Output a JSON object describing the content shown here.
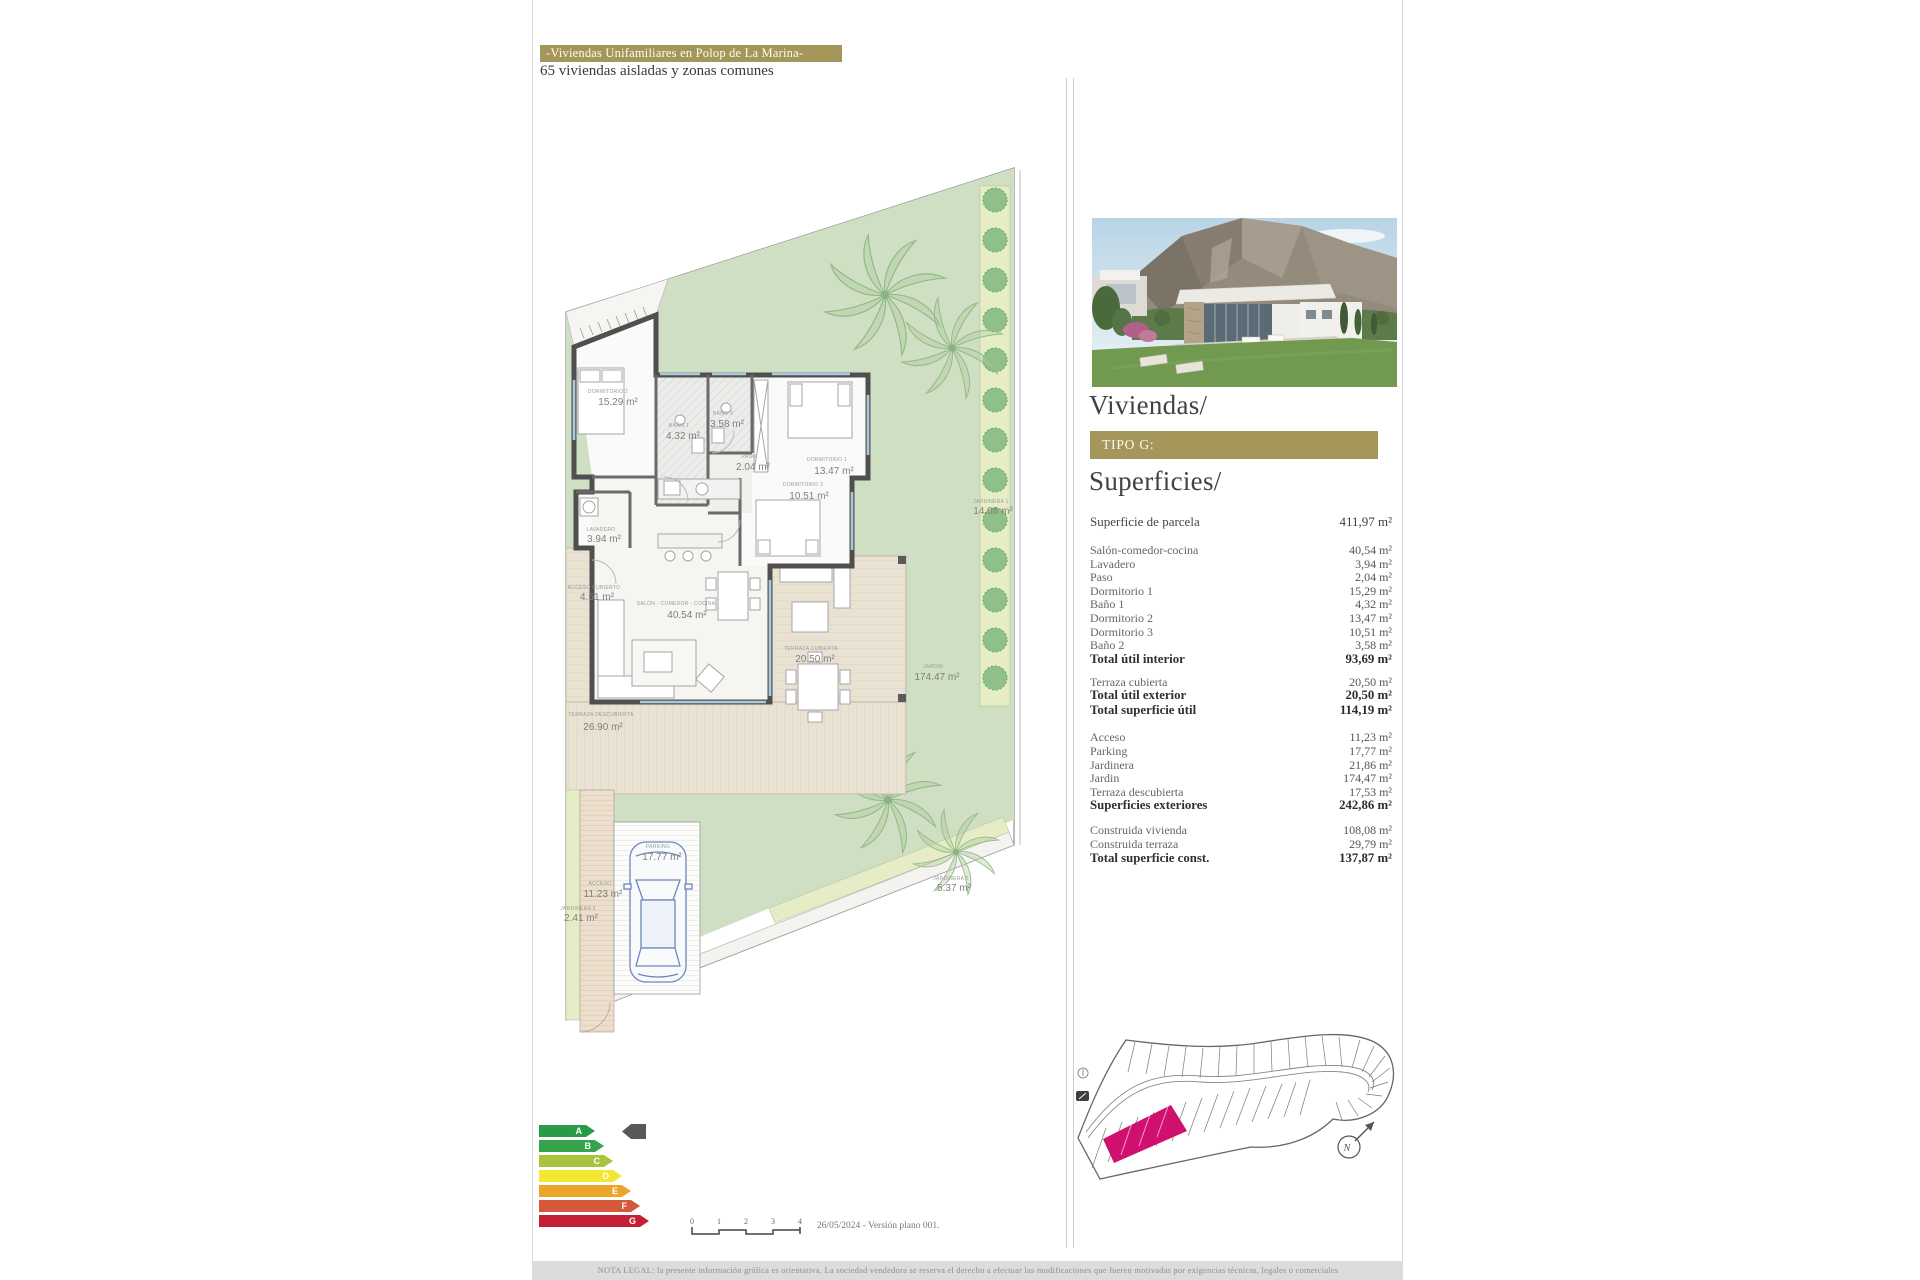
{
  "page": {
    "title": "-Viviendas Unifamiliares en Polop de La Marina-",
    "subtitle": "65 viviendas aisladas y zonas comunes",
    "legal": "NOTA LEGAL: la presente información gráfica es orientativa. La sociedad vendedora se reserva el derecho a efectuar las modificaciones que fueren motivadas por exigencias técnicas, legales o comerciales",
    "date_version": "26/05/2024 - Versión plano 001.",
    "accent_color": "#a59659"
  },
  "panel": {
    "viviendas_title": "Viviendas/",
    "tipo_label": "TIPO G:",
    "superficies_title": "Superficies/",
    "parcel": {
      "label": "Superficie de parcela",
      "value": "411,97 m²"
    },
    "interior": {
      "rows": [
        {
          "label": "Salón-comedor-cocina",
          "value": "40,54 m²"
        },
        {
          "label": "Lavadero",
          "value": "3,94 m²"
        },
        {
          "label": "Paso",
          "value": "2,04 m²"
        },
        {
          "label": "Dormitorio 1",
          "value": "15,29 m²"
        },
        {
          "label": "Baño 1",
          "value": "4,32 m²"
        },
        {
          "label": "Dormitorio 2",
          "value": "13,47 m²"
        },
        {
          "label": "Dormitorio 3",
          "value": "10,51 m²"
        },
        {
          "label": "Baño 2",
          "value": "3,58 m²"
        }
      ],
      "total": {
        "label": "Total útil interior",
        "value": "93,69 m²"
      }
    },
    "exterior_util": {
      "rows": [
        {
          "label": "Terraza cubierta",
          "value": "20,50 m²"
        }
      ],
      "total": {
        "label": "Total útil exterior",
        "value": "20,50 m²"
      },
      "total2": {
        "label": "Total superficie útil",
        "value": "114,19 m²"
      }
    },
    "exteriores": {
      "rows": [
        {
          "label": "Acceso",
          "value": "11,23 m²"
        },
        {
          "label": "Parking",
          "value": "17,77 m²"
        },
        {
          "label": "Jardinera",
          "value": "21,86 m²"
        },
        {
          "label": "Jardin",
          "value": "174,47 m²"
        },
        {
          "label": "Terraza descubierta",
          "value": "17,53 m²"
        }
      ],
      "total": {
        "label": "Superficies exteriores",
        "value": "242,86 m²"
      }
    },
    "construida": {
      "rows": [
        {
          "label": "Construida vivienda",
          "value": "108,08 m²"
        },
        {
          "label": "Construida terraza",
          "value": "29,79 m²"
        }
      ],
      "total": {
        "label": "Total superficie const.",
        "value": "137,87 m²"
      }
    }
  },
  "plan": {
    "labels": [
      {
        "name": "DORMITORIO 2",
        "area": "15.29 m²"
      },
      {
        "name": "BAÑO 1",
        "area": "4.32 m²"
      },
      {
        "name": "BAÑO 2",
        "area": "3.58 m²"
      },
      {
        "name": "PASO",
        "area": "2.04 m²"
      },
      {
        "name": "DORMITORIO 1",
        "area": "13.47 m²"
      },
      {
        "name": "DORMITORIO 3",
        "area": "10.51 m²"
      },
      {
        "name": "LAVADERO",
        "area": "3.94 m²"
      },
      {
        "name": "ACCESO CUBIERTO",
        "area": "4.51 m²"
      },
      {
        "name": "SALÓN - COMEDOR - COCINA",
        "area": "40.54 m²"
      },
      {
        "name": "TERRAZA CUBIERTA",
        "area": "20.50 m²"
      },
      {
        "name": "JARDIN",
        "area": "174.47 m²"
      },
      {
        "name": "TERRAZA DESCUBIERTA",
        "area": "26.90 m²"
      },
      {
        "name": "JARDINERA 1",
        "area": "14.08 m²"
      },
      {
        "name": "PARKING",
        "area": "17.77 m²"
      },
      {
        "name": "ACCESO",
        "area": "11.23 m²"
      },
      {
        "name": "JARDINERA 3",
        "area": "2.41 m²"
      },
      {
        "name": "JARDINERA 2",
        "area": "5.37 m²"
      }
    ]
  },
  "energy": {
    "items": [
      {
        "letter": "A",
        "color": "#2a9a47"
      },
      {
        "letter": "B",
        "color": "#35a34c"
      },
      {
        "letter": "C",
        "color": "#a6c53d"
      },
      {
        "letter": "D",
        "color": "#f4e731"
      },
      {
        "letter": "E",
        "color": "#eda42b"
      },
      {
        "letter": "F",
        "color": "#d3593a"
      },
      {
        "letter": "G",
        "color": "#c62039"
      }
    ],
    "pointer_color": "#58595b"
  },
  "scale_bar": {
    "ticks": [
      "0",
      "1",
      "2",
      "3",
      "4"
    ]
  },
  "site_plan": {
    "north": "N",
    "highlight_color": "#d0106e"
  }
}
